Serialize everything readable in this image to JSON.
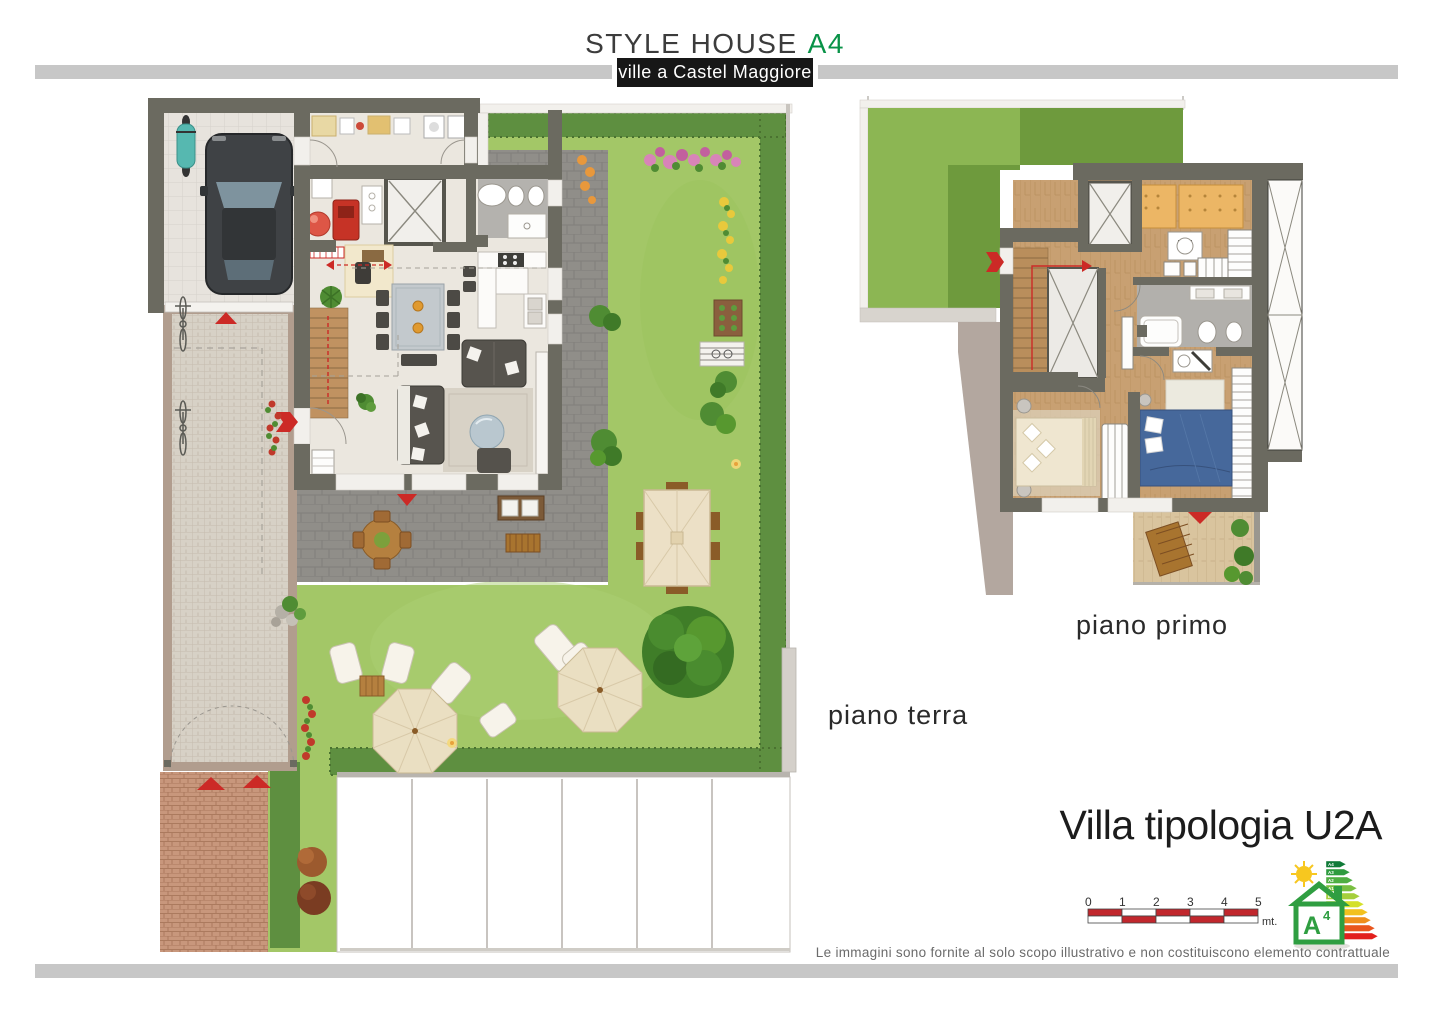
{
  "header": {
    "title": "STYLE HOUSE",
    "badge": "A4",
    "subtitle": "ville a Castel Maggiore"
  },
  "floor_labels": {
    "ground": "piano terra",
    "first": "piano primo"
  },
  "villa_title": "Villa tipologia U2A",
  "scale_bar": {
    "ticks": [
      "0",
      "1",
      "2",
      "3",
      "4",
      "5"
    ],
    "unit": "mt."
  },
  "energy_badge": {
    "class_letter": "A",
    "class_exponent": "4",
    "bar_labels": [
      "A4",
      "A3",
      "A2",
      "A1",
      "B",
      "C",
      "D",
      "E",
      "F",
      "G"
    ]
  },
  "disclaimer": "Le immagini sono fornite al solo scopo illustrativo e non costituiscono elemento contrattuale",
  "colors": {
    "accent_green": "#089247",
    "marker_red": "#cc2a26",
    "bar_gray": "#c7c7c7",
    "wall": "#6b6a60",
    "lawn": "#a3c767",
    "hedge": "#5e8f40",
    "wood_floor": "#c8a072",
    "subtitle_bg": "#171717"
  }
}
